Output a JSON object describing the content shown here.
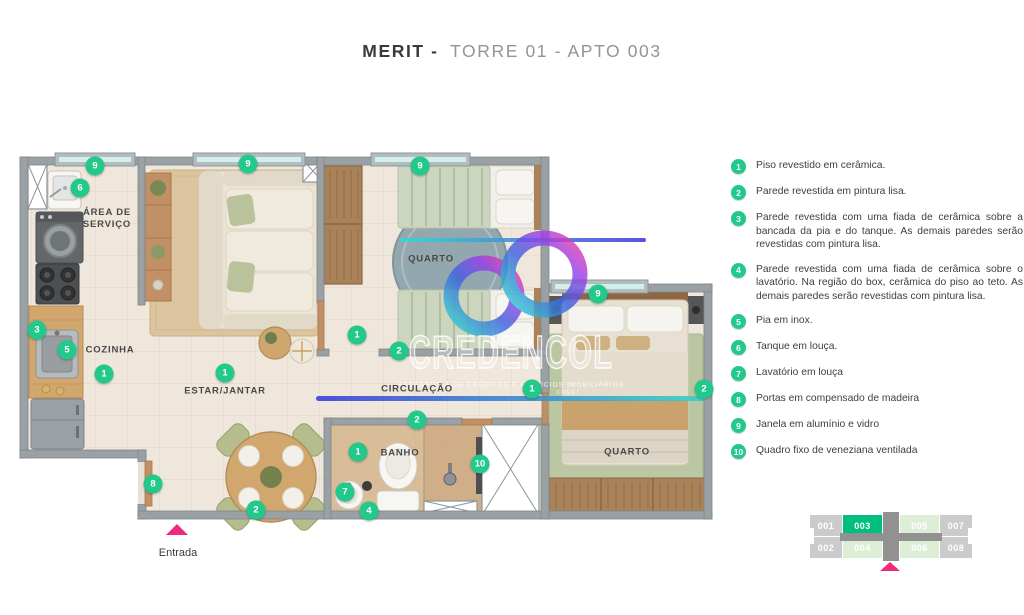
{
  "title": {
    "brand": "MERIT -",
    "rest": "TORRE 01 - APTO 003"
  },
  "legend": {
    "items": [
      {
        "n": "1",
        "text": "Piso revestido em cerâmica."
      },
      {
        "n": "2",
        "text": "Parede revestida em pintura lisa."
      },
      {
        "n": "3",
        "text": "Parede revestida com uma fiada de cerâmica sobre a bancada da pia e do tanque. As demais paredes serão revestidas com pintura lisa."
      },
      {
        "n": "4",
        "text": "Parede revestida com uma fiada de cerâmica sobre o lavatório. Na região do box, cerâmica do piso ao teto. As demais paredes serão revestidas com pintura lisa."
      },
      {
        "n": "5",
        "text": "Pia em inox."
      },
      {
        "n": "6",
        "text": "Tanque em louça."
      },
      {
        "n": "7",
        "text": "Lavatório em louça"
      },
      {
        "n": "8",
        "text": "Portas em compensado de madeira"
      },
      {
        "n": "9",
        "text": "Janela em alumínio e vidro"
      },
      {
        "n": "10",
        "text": "Quadro fixo de veneziana ventilada"
      }
    ]
  },
  "plan": {
    "labels": {
      "servico": "ÁREA DE SERVIÇO",
      "cozinha": "COZINHA",
      "estar": "ESTAR/JANTAR",
      "quarto1": "QUARTO",
      "circulacao": "CIRCULAÇÃO",
      "banho": "BANHO",
      "quarto2": "QUARTO"
    },
    "markers": [
      {
        "n": "9"
      },
      {
        "n": "6"
      },
      {
        "n": "3"
      },
      {
        "n": "5"
      },
      {
        "n": "1"
      },
      {
        "n": "9"
      },
      {
        "n": "9"
      },
      {
        "n": "1"
      },
      {
        "n": "1"
      },
      {
        "n": "2"
      },
      {
        "n": "1"
      },
      {
        "n": "2"
      },
      {
        "n": "9"
      },
      {
        "n": "2"
      },
      {
        "n": "1"
      },
      {
        "n": "7"
      },
      {
        "n": "4"
      },
      {
        "n": "10"
      },
      {
        "n": "8"
      },
      {
        "n": "2"
      }
    ]
  },
  "entrance": {
    "label": "Entrada"
  },
  "watermark": {
    "brand": "CREDENCOL",
    "subtitle": "ASSESSORIA DE CRÉDITOS E NEGÓCIOS IMOBILIÁRIOS",
    "creci": "CRECI"
  },
  "keyplan": {
    "highlight": "003",
    "units": [
      {
        "label": "001",
        "state": "gray"
      },
      {
        "label": "003",
        "state": "highlight"
      },
      {
        "label": "005",
        "state": "light-green"
      },
      {
        "label": "007",
        "state": "gray"
      },
      {
        "label": "002",
        "state": "gray"
      },
      {
        "label": "004",
        "state": "light-green"
      },
      {
        "label": "006",
        "state": "light-green"
      },
      {
        "label": "008",
        "state": "gray"
      }
    ]
  },
  "colors": {
    "marker_green": "#23c88b",
    "keyplan_highlight": "#00bf7d",
    "keyplan_light": "#dcefd6",
    "keyplan_gray": "#cbcbcb",
    "entrance_pink": "#ee2a7b",
    "watermark_gradient_start": "#3c3fd9",
    "watermark_gradient_end": "#37d1c5"
  }
}
